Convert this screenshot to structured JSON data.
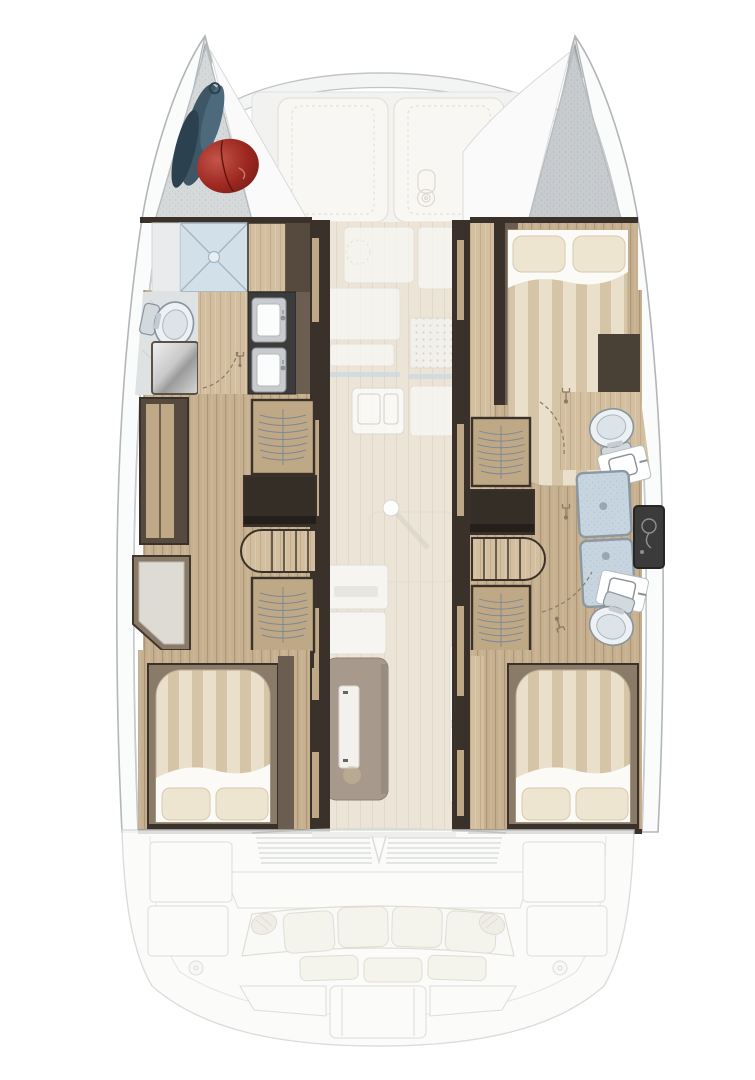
{
  "meta": {
    "title": "Catamaran accommodation floor plan — top-down deck layout",
    "diagram_type": "boat-floor-plan",
    "canvas": {
      "width": 755,
      "height": 1080
    },
    "visible_text": []
  },
  "palette": {
    "hullFill": "#fafbfb",
    "hullStroke": "#b3b6b8",
    "hullInner": "#cdcfd1",
    "forepeak": "#d6d9da",
    "forepeakDk": "#c7cbcd",
    "sailbag": "#3e5666",
    "sailbagDk": "#2c4150",
    "fender": "#9c2720",
    "fenderDk": "#6e1a15",
    "showerPan": "#d2e0e9",
    "showerLine": "#a4b7c3",
    "tile": "#dfe2e3",
    "wood": "#c6b08f",
    "woodLight": "#d3bf9f",
    "woodDoor": "#bfa886",
    "trimDark": "#3a322a",
    "wallBrown": "#6b5d4f",
    "duvetA": "#e9dfca",
    "duvetB": "#d5c5a6",
    "sheet": "#fbfaf6",
    "pillow": "#eee5d1",
    "pillowEdge": "#d6cab0",
    "seatCushion": "#dedad4",
    "seatFrame": "#8a7b69",
    "porcelain": "#eef1f3",
    "porcelainIn": "#dde4e9",
    "fixtureStroke": "#8795a0",
    "frosted": "#c6d5df",
    "frostedFrame": "#8b98a2",
    "darkUnit": "#3b3b3b",
    "steelLight": "#f0f0f0",
    "steelDark": "#9a9a9a",
    "saloonFloor": "#ece4d7",
    "galleyWhite": "#f8f7f3",
    "galleyStroke": "#e2dfd7",
    "counterBlue": "#ccdae3",
    "fridge": "#a79a8c",
    "fridgeDoor": "#f3f1ed",
    "shelfWhite": "#f6f5f1",
    "arcDash": "#8a7a66",
    "hangerLine": "#7d8894",
    "sternFill": "#fbfbfa",
    "sternStroke": "#d6d7d5",
    "benchCushion": "#f3f1e9",
    "benchStroke": "#dcd8cc"
  },
  "vessel": {
    "type": "sailing catamaran, 3-cabin / 3-head layout, bow at top",
    "bow": {
      "port_forepeak": [
        "storage locker",
        "sail-bag",
        "red-fender"
      ],
      "starboard_forepeak": [
        "storage locker (empty)"
      ],
      "forward_cockpit": [
        "port sunpad cushion",
        "starboard sunpad cushion",
        "winch"
      ]
    },
    "port_hull": {
      "forward_head": [
        "shower pan",
        "toilet",
        "washer unit",
        "twin-sink vanity",
        "door swing"
      ],
      "midship": [
        "wardrobe",
        "hanging locker fwd",
        "desk unit",
        "companionway steps",
        "hanging locker aft",
        "window bench seat"
      ],
      "aft_cabin": [
        "double berth",
        "striped duvet",
        "turned sheet",
        "two pillows"
      ]
    },
    "starboard_hull": {
      "forward_cabin": [
        "double berth",
        "two pillows",
        "striped duvet",
        "turned sheet"
      ],
      "midship": [
        "forward toilet",
        "forward sink",
        "frosted shower doors",
        "shower column",
        "aft sink",
        "aft toilet",
        "hanging locker fwd",
        "dark cabinet",
        "companionway steps",
        "hanging locker aft",
        "door swings"
      ],
      "aft_cabin": [
        "double berth",
        "striped duvet",
        "turned sheet",
        "two pillows"
      ]
    },
    "saloon": {
      "galley": [
        "counter blocks",
        "cooktop grate",
        "twin sink",
        "counter edges"
      ],
      "furniture": [
        "table pedestal mount",
        "refrigerator column",
        "white lockers",
        "shelf units"
      ]
    },
    "stern": {
      "aft_cockpit": [
        "louvered coaming vents",
        "bench with four back cushions",
        "three seat cushions",
        "two armrests",
        "port lockers",
        "starboard lockers",
        "deck fills",
        "transom platform"
      ]
    }
  }
}
